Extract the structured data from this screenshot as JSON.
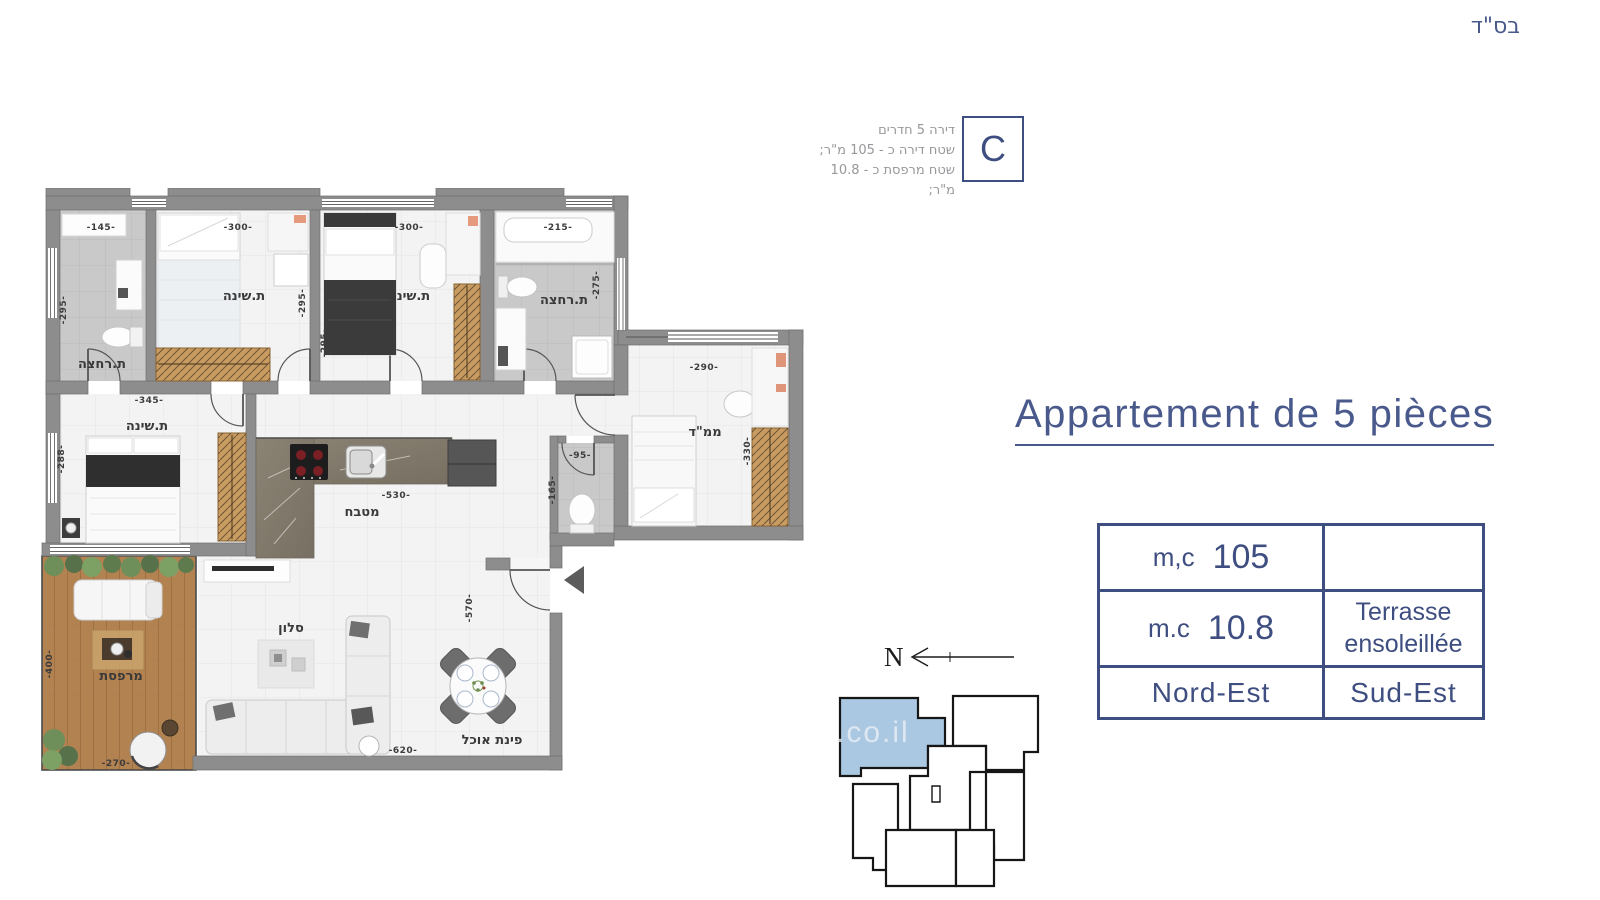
{
  "header": {
    "bsd": "בס\"ד"
  },
  "info": {
    "lines": [
      "דירה 5 חדרים",
      "שטח דירה כ - 105 מ\"ר;",
      "שטח מרפסת כ - 10.8 מ\"ר;"
    ],
    "unit_letter": "C"
  },
  "title": {
    "text": "Appartement de 5 pièces"
  },
  "table": {
    "r1c1_label": "m,c",
    "r1c1_value": "105",
    "r1c2": "",
    "r2c1_label": "m.c",
    "r2c1_value": "10.8",
    "r2c2_line1": "Terrasse",
    "r2c2_line2": "ensoleillée",
    "r3c1": "Nord-Est",
    "r3c2": "Sud-Est"
  },
  "compass": {
    "label": "N"
  },
  "keyplan": {
    "watermark": ".co.il"
  },
  "plan": {
    "labels": {
      "bath1": "ת.רחצה",
      "bed1": "ת.שינה",
      "bed2": "ת.שינה",
      "bath2": "ת.רחצה",
      "bed3": "ת.שינה",
      "mamad": "ממ\"ד",
      "kitchen": "מטבח",
      "salon": "סלון",
      "dining": "פינת אוכל",
      "terrace": "מרפסת"
    },
    "dims": {
      "bath1_w": "-145-",
      "bed1_w": "-300-",
      "bed2_w": "-300-",
      "bath2_w": "-215-",
      "bath1_h": "-295-",
      "bed1_h": "-295-",
      "bed2_h": "-295-",
      "bath2_h": "-275-",
      "mamad_w": "-290-",
      "mamad_h": "-330-",
      "wc_w": "-95-",
      "wc_h": "-165-",
      "bed3_w": "-345-",
      "bed3_h": "-288-",
      "kitchen_w": "-530-",
      "terrace_h": "-400-",
      "terrace_w": "-270-",
      "living_w": "-620-",
      "living_h": "-570-"
    }
  },
  "colors": {
    "navy": "#3e4e80",
    "title_blue": "#4a598c",
    "wall_gray": "#8d8d8d",
    "highlight_unit": "#abc8e2",
    "wood": "#c89b60",
    "deck": "#b28251"
  }
}
